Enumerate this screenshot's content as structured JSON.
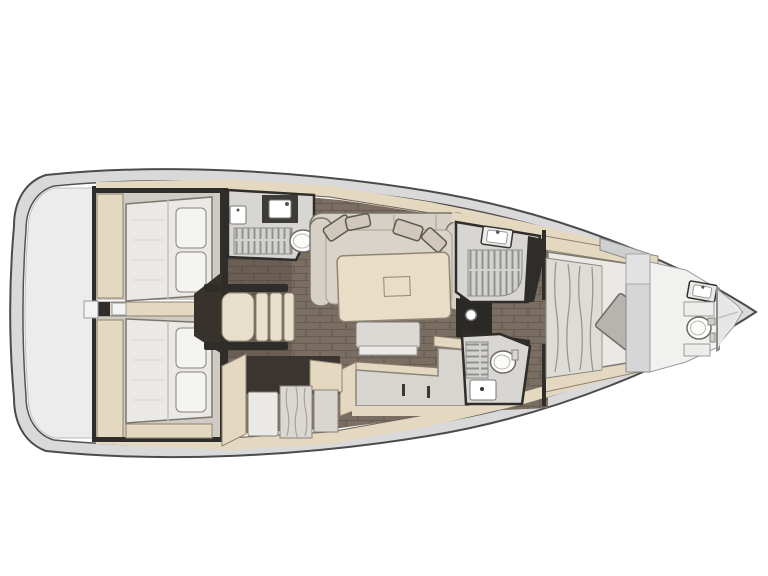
{
  "colors": {
    "hull_rim": "#d9d9d9",
    "hull_line": "#4b4b4b",
    "deck": "#ffffff",
    "stern": "#ececec",
    "beige": "#e4d8c1",
    "beige_edge": "#8d8271",
    "wall": "#2f2d2a",
    "room": "#d8d6d2",
    "bed": "#eae9e5",
    "bed_edge": "#7d786f",
    "pillow": "#f4f4f2",
    "sofa": "#d6d0c6",
    "sofa_edge": "#7b7568",
    "cushion": "#d0c8ba",
    "table": "#e8ddc6",
    "table_edge": "#8f8674",
    "bench": "#dcd8d3",
    "step": "#e9e0cb",
    "marble": "#dbd8d3",
    "panel": "#d6d6d6",
    "fixture": "#ffffff",
    "wood": "#7a6d62",
    "wood_seam": "#675c52",
    "grate": "#d3d2ce",
    "grate_line": "#92918d"
  }
}
